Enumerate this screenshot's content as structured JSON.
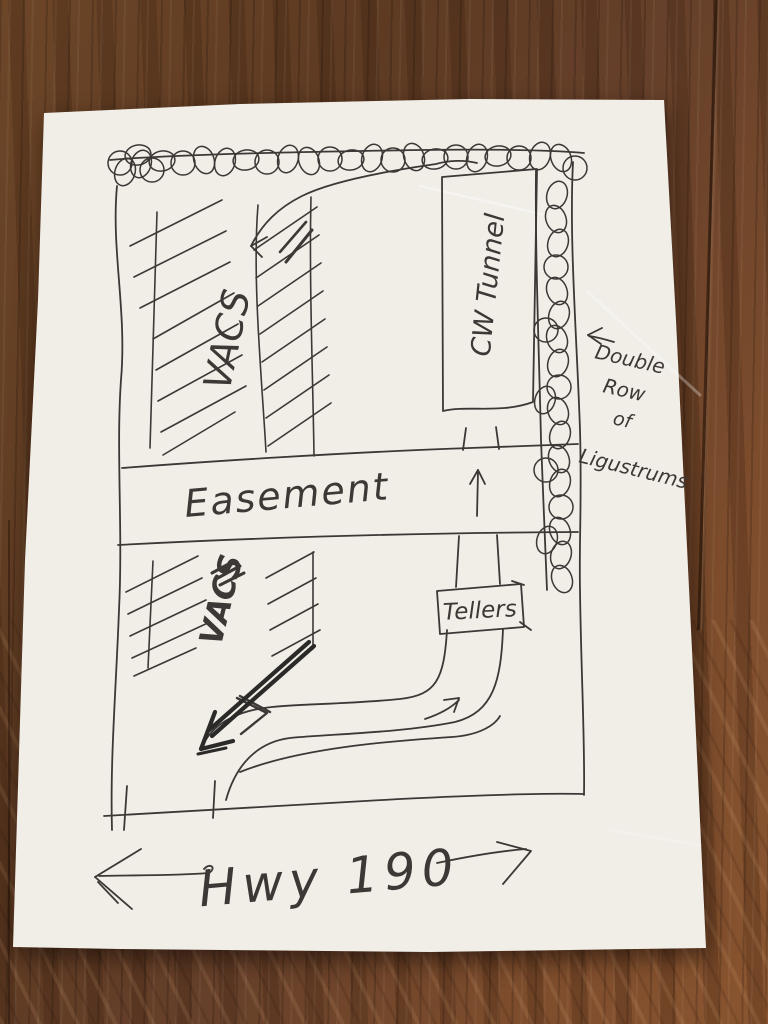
{
  "photo": {
    "paper_color": "#f1eee8",
    "ink_color": "#3b3836",
    "bold_ink_color": "#2c2a28",
    "table_wood_color": "#66402a"
  },
  "sketch": {
    "top_area": {
      "vacs_label": "VACS",
      "cw_tunnel_label": "CW Tunnel"
    },
    "middle_band": {
      "easement_label": "Easement"
    },
    "bottom_area": {
      "vacs_label": "VACS",
      "tellers_label": "Tellers"
    },
    "highway": {
      "label": "Hwy 190"
    },
    "ligustrum_note": {
      "line1": "Double",
      "line2": "Row",
      "line3": "of",
      "line4": "Ligustrums"
    }
  }
}
